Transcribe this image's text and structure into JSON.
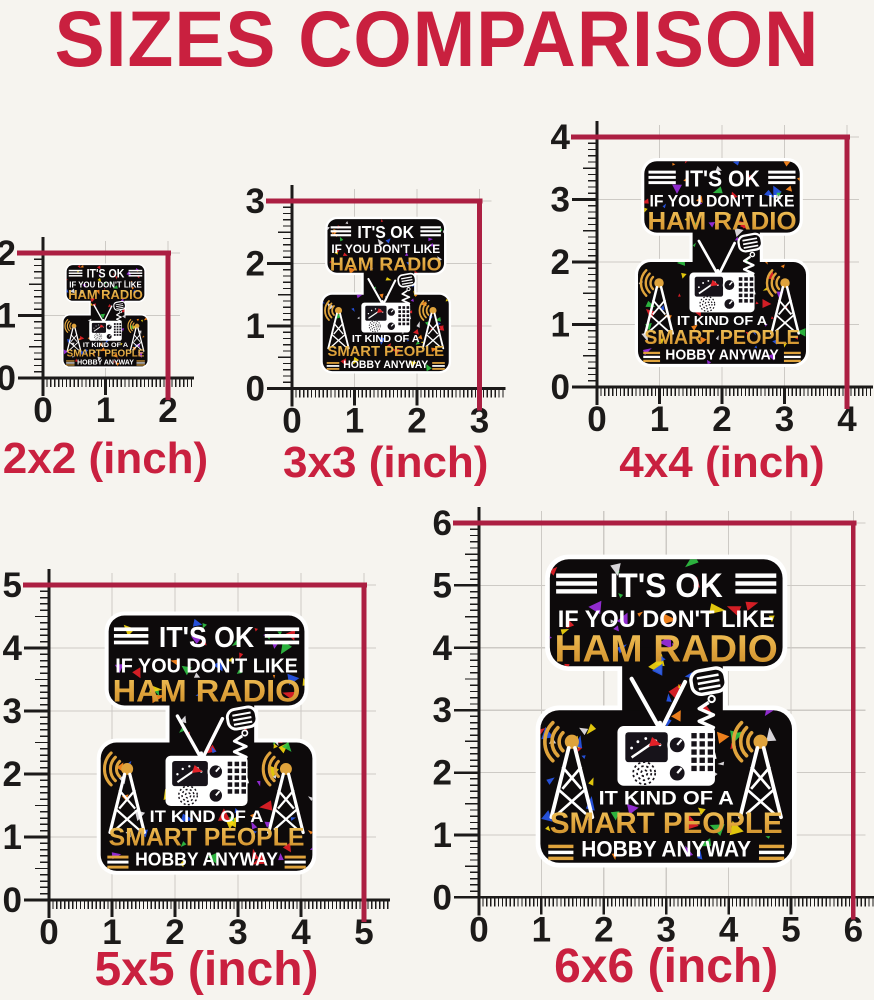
{
  "title": "SIZES COMPARISON",
  "panels": [
    {
      "label": "2x2 (inch)",
      "size": 2,
      "ticks": [
        "0",
        "1",
        "2"
      ]
    },
    {
      "label": "3x3 (inch)",
      "size": 3,
      "ticks": [
        "0",
        "1",
        "2",
        "3"
      ]
    },
    {
      "label": "4x4 (inch)",
      "size": 4,
      "ticks": [
        "0",
        "1",
        "2",
        "3",
        "4"
      ]
    },
    {
      "label": "5x5 (inch)",
      "size": 5,
      "ticks": [
        "0",
        "1",
        "2",
        "3",
        "4",
        "5"
      ]
    },
    {
      "label": "6x6 (inch)",
      "size": 6,
      "ticks": [
        "0",
        "1",
        "2",
        "3",
        "4",
        "5",
        "6"
      ]
    }
  ],
  "sticker": {
    "top_lines": [
      "IT'S OK",
      "IF YOU DON'T LIKE",
      "HAM RADIO"
    ],
    "bottom_lines": [
      "IT KIND OF A",
      "SMART PEOPLE",
      "HOBBY ANYWAY"
    ]
  },
  "colors": {
    "background": "#f6f4ef",
    "title_red": "#c9203f",
    "label_red": "#c9203f",
    "dimension_red": "#ac1f42",
    "axis_black": "#1c1a19",
    "grid_gray": "#cdcac5",
    "sticker_black": "#0d0a0b",
    "sticker_white": "#ffffff",
    "sticker_gold": "#dfa33c",
    "sticker_gold_light": "#f2c65c",
    "sticker_gold_dark": "#c78b28",
    "confetti": [
      "#e32128",
      "#e32128",
      "#2fc043",
      "#2757ea",
      "#f2d60e",
      "#ff8a1e",
      "#9b2fe0",
      "#e8e6ea"
    ]
  }
}
